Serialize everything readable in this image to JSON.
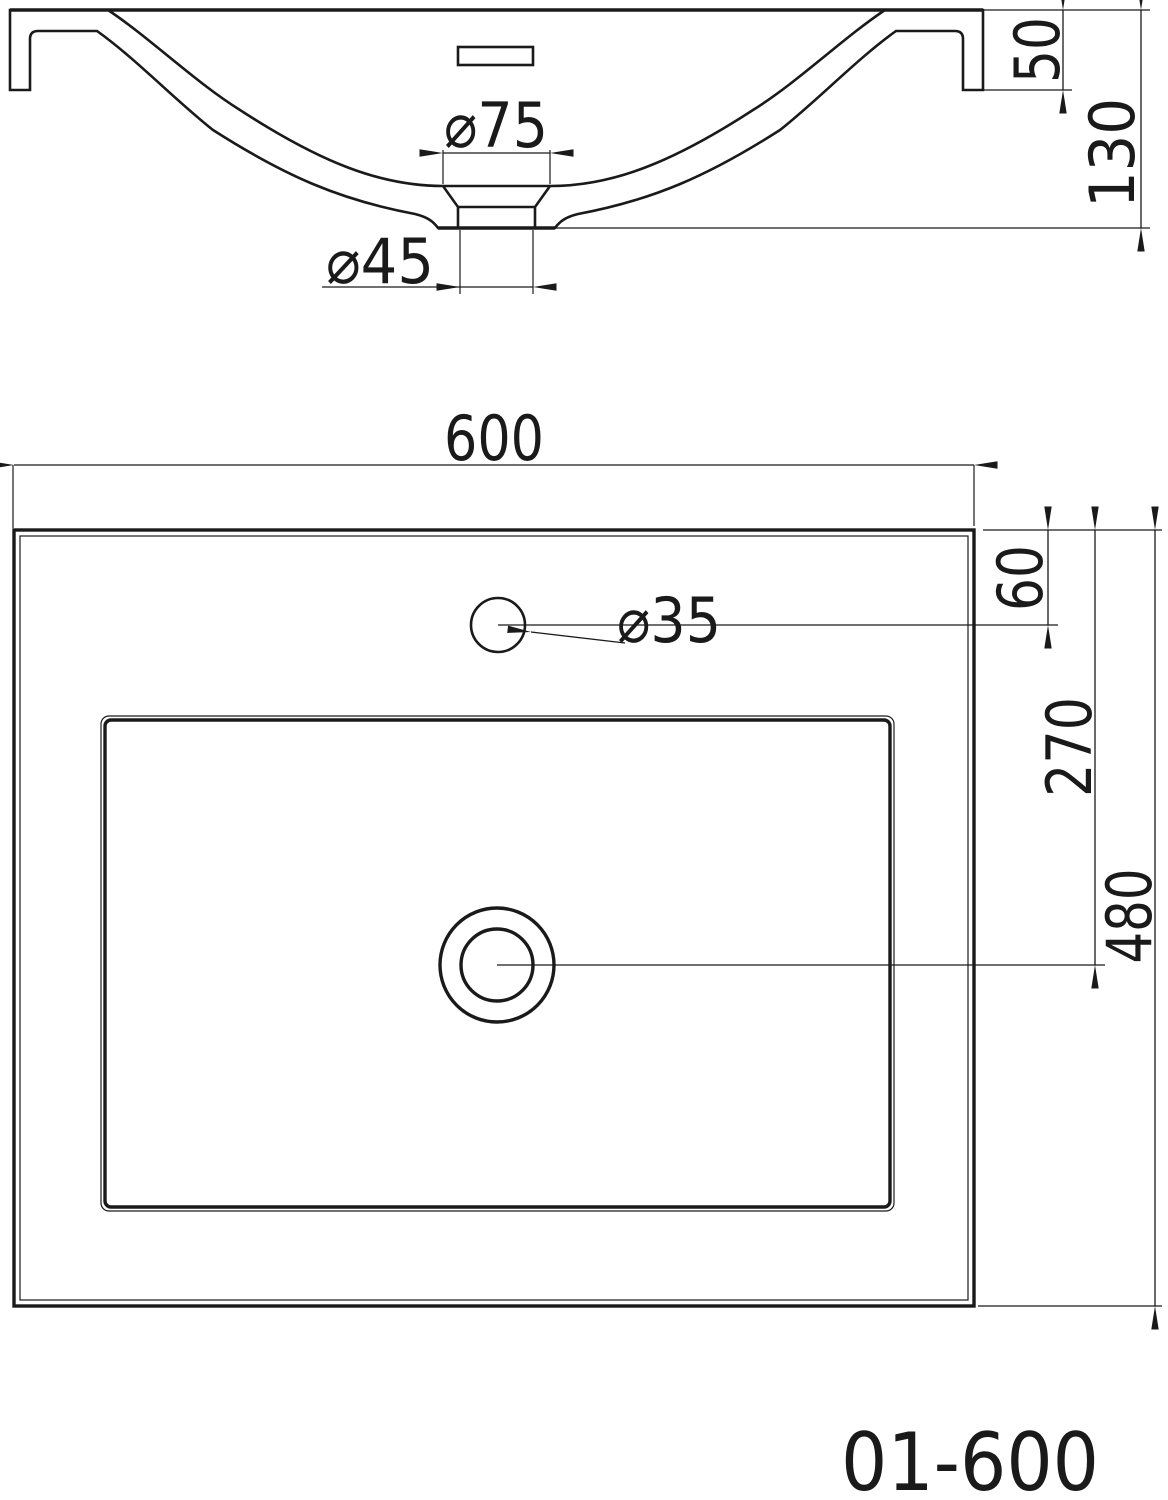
{
  "page": {
    "background": "#ffffff",
    "line_color": "#1a1a1a",
    "kind": "technical drawing - bathroom basin"
  },
  "title_block": {
    "model_number": "01-600"
  },
  "section_view": {
    "name": "front-section-view",
    "dims": {
      "drain_recess_diameter": "⌀75",
      "drain_hole_diameter": "⌀45",
      "rim_height": "50",
      "overall_height": "130"
    }
  },
  "plan_view": {
    "name": "top-plan-view",
    "dims": {
      "overall_width": "600",
      "faucet_hole_diameter": "⌀35",
      "faucet_center_from_back": "60",
      "drain_center_from_back": "270",
      "overall_depth": "480"
    }
  }
}
